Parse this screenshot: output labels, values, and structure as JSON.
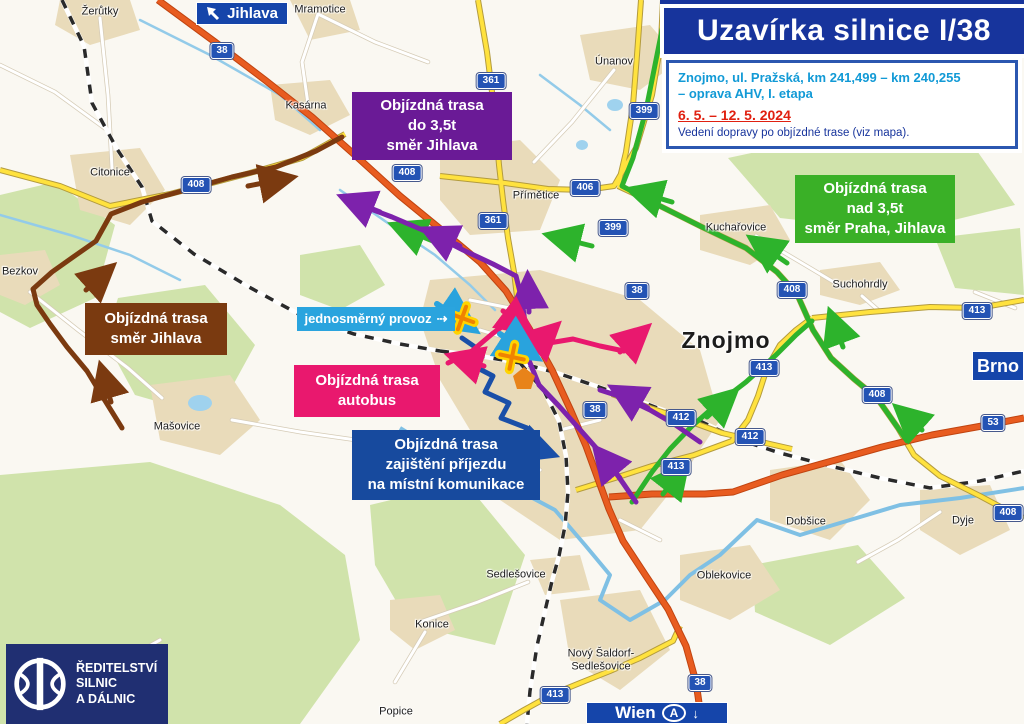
{
  "title": {
    "text": "Uzavírka silnice I/38"
  },
  "info": {
    "line1": "Znojmo, ul. Pražská, km 241,499 – km 240,255",
    "line2": "– oprava AHV, I. etapa",
    "dates": "6. 5. – 12. 5. 2024",
    "note": "Vedení dopravy po objízdné trase (viz mapa)."
  },
  "legend": {
    "purple": {
      "text": "Objízdná trasa\ndo 3,5t\nsměr Jihlava",
      "color": "#6a1a96"
    },
    "green": {
      "text": "Objízdná trasa\nnad 3,5t\nsměr Praha, Jihlava",
      "color": "#3ab027"
    },
    "brown": {
      "text": "Objízdná trasa\nsměr Jihlava",
      "color": "#7a3a10"
    },
    "pink": {
      "text": "Objízdná trasa\nautobus",
      "color": "#e9186e"
    },
    "blue": {
      "text": "Objízdná trasa\nzajištění příjezdu\nna místní komunikace",
      "color": "#174a9e"
    },
    "oneway": {
      "text": "jednosměrný provoz",
      "arrow": "⇢",
      "color": "#2aa4de"
    }
  },
  "signs": {
    "jihlava": "Jihlava",
    "brno": "Brno",
    "wien": "Wien",
    "wien_country": "A",
    "wien_arrow": "↓"
  },
  "logo": {
    "text": "ŘEDITELSTVÍ\nSILNIC\nA DÁLNIC"
  },
  "towns": [
    {
      "label": "Žerůtky",
      "x": 100,
      "y": 12
    },
    {
      "label": "Mramotice",
      "x": 320,
      "y": 10
    },
    {
      "label": "Únanov",
      "x": 614,
      "y": 62
    },
    {
      "label": "Kasárna",
      "x": 306,
      "y": 106
    },
    {
      "label": "Citonice",
      "x": 110,
      "y": 173
    },
    {
      "label": "Bezkov",
      "x": 20,
      "y": 272
    },
    {
      "label": "Přímětice",
      "x": 536,
      "y": 196
    },
    {
      "label": "Kuchařovice",
      "x": 736,
      "y": 228
    },
    {
      "label": "Suchohrdly",
      "x": 860,
      "y": 285
    },
    {
      "label": "Znojmo",
      "x": 726,
      "y": 340,
      "cls": "big"
    },
    {
      "label": "Mašovice",
      "x": 177,
      "y": 427
    },
    {
      "label": "Dobšice",
      "x": 806,
      "y": 522
    },
    {
      "label": "Dyje",
      "x": 963,
      "y": 521
    },
    {
      "label": "Oblekovice",
      "x": 724,
      "y": 576
    },
    {
      "label": "Sedlešovice",
      "x": 516,
      "y": 575
    },
    {
      "label": "Konice",
      "x": 432,
      "y": 625
    },
    {
      "label": "Nový Šaldorf-\nSedlešovice",
      "x": 601,
      "y": 660
    },
    {
      "label": "Popice",
      "x": 396,
      "y": 712
    }
  ],
  "badges": [
    {
      "num": "38",
      "x": 222,
      "y": 51
    },
    {
      "num": "38",
      "x": 637,
      "y": 291
    },
    {
      "num": "38",
      "x": 595,
      "y": 410
    },
    {
      "num": "38",
      "x": 700,
      "y": 683
    },
    {
      "num": "361",
      "x": 491,
      "y": 81
    },
    {
      "num": "361",
      "x": 493,
      "y": 221
    },
    {
      "num": "399",
      "x": 644,
      "y": 111
    },
    {
      "num": "399",
      "x": 613,
      "y": 228
    },
    {
      "num": "406",
      "x": 585,
      "y": 188
    },
    {
      "num": "408",
      "x": 196,
      "y": 185
    },
    {
      "num": "408",
      "x": 407,
      "y": 173
    },
    {
      "num": "408",
      "x": 792,
      "y": 290
    },
    {
      "num": "408",
      "x": 877,
      "y": 395
    },
    {
      "num": "408",
      "x": 1008,
      "y": 513
    },
    {
      "num": "412",
      "x": 681,
      "y": 418
    },
    {
      "num": "412",
      "x": 750,
      "y": 437
    },
    {
      "num": "413",
      "x": 764,
      "y": 368
    },
    {
      "num": "413",
      "x": 977,
      "y": 311
    },
    {
      "num": "413",
      "x": 676,
      "y": 467
    },
    {
      "num": "413",
      "x": 555,
      "y": 695
    },
    {
      "num": "53",
      "x": 993,
      "y": 423
    }
  ]
}
